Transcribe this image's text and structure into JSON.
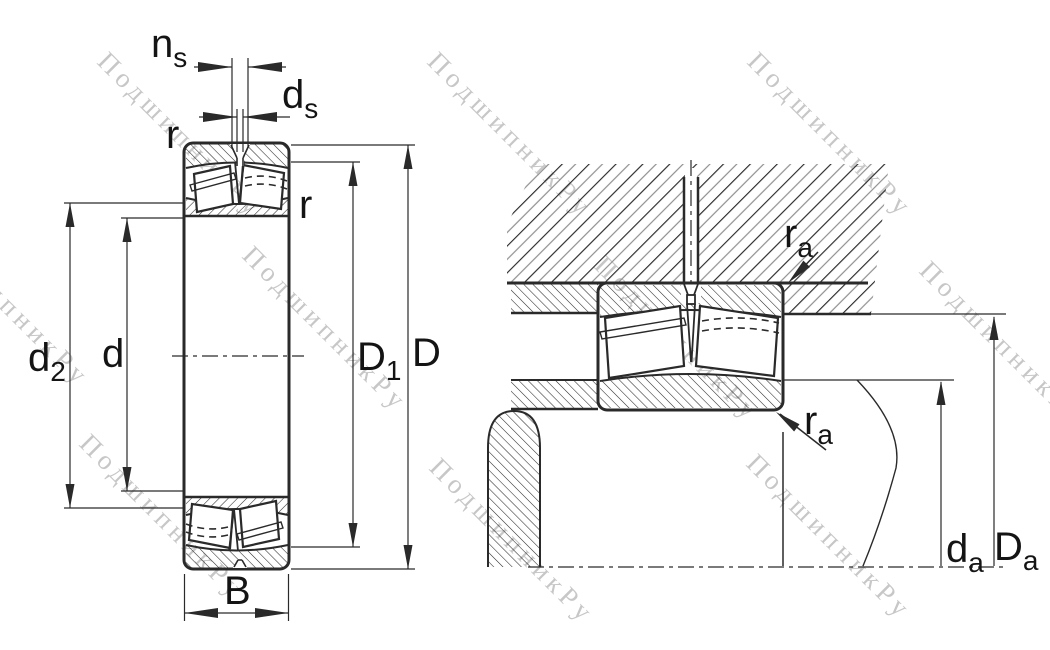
{
  "watermark": {
    "text": "ПодшипникРу"
  },
  "colors": {
    "line": "#2a2a2a",
    "label": "#141414",
    "hatch_gray": "#8f8f8f",
    "watermark": "#c7c7c7",
    "background": "#ffffff"
  },
  "labels": {
    "ns": {
      "main": "n",
      "sub": "s"
    },
    "ds": {
      "main": "d",
      "sub": "s"
    },
    "r_top": {
      "main": "r",
      "sub": ""
    },
    "r_right": {
      "main": "r",
      "sub": ""
    },
    "d2": {
      "main": "d",
      "sub": "2"
    },
    "d": {
      "main": "d",
      "sub": ""
    },
    "D1": {
      "main": "D",
      "sub": "1"
    },
    "D": {
      "main": "D",
      "sub": ""
    },
    "B": {
      "main": "B",
      "sub": ""
    },
    "ra_upper": {
      "main": "r",
      "sub": "a"
    },
    "ra_lower": {
      "main": "r",
      "sub": "a"
    },
    "da": {
      "main": "d",
      "sub": "a"
    },
    "Da": {
      "main": "D",
      "sub": "a"
    }
  }
}
